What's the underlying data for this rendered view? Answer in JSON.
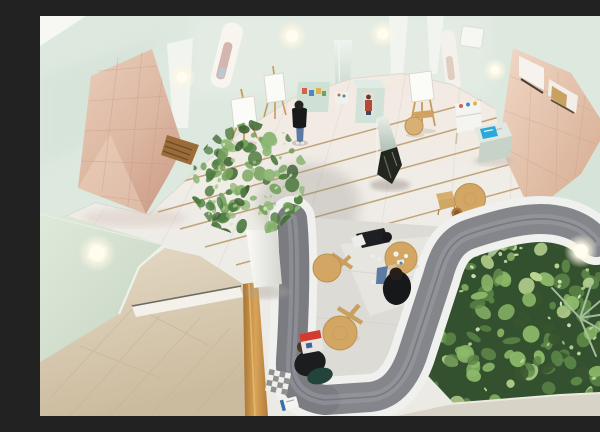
{
  "scene": {
    "caption": "Overhead view of a museum atrium lounge: curved grey sofa around round wooden tables, a living plant wall, an indoor tree, easels with blank canvases, mirrored display plinths, pink tiled walls, pale mint walls with glowing sconce lamps, and four visitors.",
    "setting": "gallery atrium seen from a balcony above",
    "people_count": 4,
    "easel_count": 3,
    "lamp_count": 6,
    "objects": [
      {
        "name": "curved-sofa",
        "label": "Curved grey sofa on white plinth"
      },
      {
        "name": "plant-wall",
        "label": "Dense green plant garden"
      },
      {
        "name": "indoor-tree",
        "label": "Indoor tree in white planter"
      },
      {
        "name": "mirror-sculpture",
        "label": "Faceted mirror monolith sculpture"
      },
      {
        "name": "art-easels",
        "label": "Wooden easels with white canvases"
      },
      {
        "name": "display-plinths",
        "label": "Mint display plinths with small artworks"
      },
      {
        "name": "blue-flyer",
        "label": "Blue booklet on mirrored plinth"
      },
      {
        "name": "round-tables",
        "label": "Round wooden tables with cross legs"
      },
      {
        "name": "wooden-railing",
        "label": "Oak balcony railing"
      },
      {
        "name": "checkered-cushion",
        "label": "Checkered floor cushion"
      },
      {
        "name": "magazine",
        "label": "Red and white magazine"
      },
      {
        "name": "pink-tile-walls",
        "label": "Pink tiled sloping walls"
      },
      {
        "name": "wall-lamps",
        "label": "Glowing wall sconce lamps"
      }
    ],
    "palette": {
      "mint": "#dde8df",
      "mintShade": "#cfdfd2",
      "canopyMint": "#d5e2d4",
      "pilaster": "#f1f4ef",
      "ceiling": "#f7f8f4",
      "pinkTile": "#ddbba7",
      "pinkLight": "#eed5c3",
      "pinkDark": "#cf9f8a",
      "floorWhite": "#efece7",
      "floorPink": "#f3eae2",
      "brass": "#b4935f",
      "beige": "#ddd0ba",
      "beigeDark": "#c9b89c",
      "railWood": "#c08a46",
      "sofaGray": "#85868c",
      "sofaDark": "#6e6f76",
      "sofaLight": "#9da0a5",
      "sofaBase": "#f0f1ee",
      "innerFloor": "#dcdbd6",
      "plantDark": "#39552f",
      "plantMid": "#5d8748",
      "plantLight": "#8db96a",
      "plantPale": "#bcd893",
      "palm": "#a9c2a1",
      "treeDark": "#3c6132",
      "treeGreen": "#4f7d41",
      "treeLight": "#74a25b",
      "wood": "#d3a763",
      "woodDark": "#b9884b",
      "denim": "#5b7ba3",
      "dark": "#1d1e21",
      "accentBlue": "#2aa9da",
      "magRed": "#d23b2f",
      "pillowGreen": "#23443a",
      "lamp": "#fffdf0",
      "lowerBand": "#d7d3c7"
    }
  }
}
